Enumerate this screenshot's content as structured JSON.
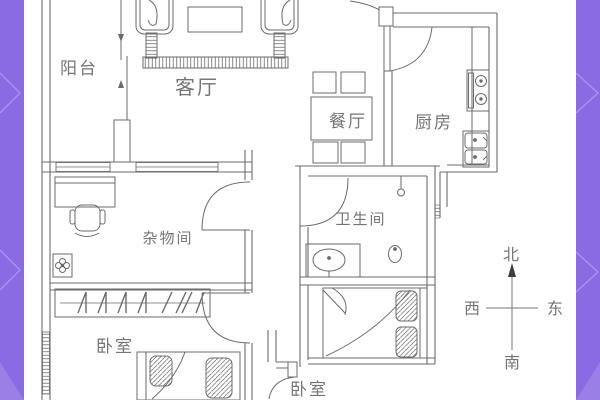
{
  "page": {
    "background": "#ffffff",
    "accent_purple": "#8a6be4",
    "line_color": "#6b6b6b",
    "label_color": "#757575"
  },
  "floorplan": {
    "rooms": [
      {
        "id": "balcony",
        "label": "阳台"
      },
      {
        "id": "living-room",
        "label": "客厅"
      },
      {
        "id": "dining-room",
        "label": "餐厅"
      },
      {
        "id": "kitchen",
        "label": "厨房"
      },
      {
        "id": "storage-room",
        "label": "杂物间"
      },
      {
        "id": "bathroom",
        "label": "卫生间"
      },
      {
        "id": "bedroom-left",
        "label": "卧室"
      },
      {
        "id": "bedroom-bottom",
        "label": "卧室"
      }
    ],
    "compass": {
      "north": "北",
      "south": "南",
      "east": "东",
      "west": "西"
    }
  }
}
